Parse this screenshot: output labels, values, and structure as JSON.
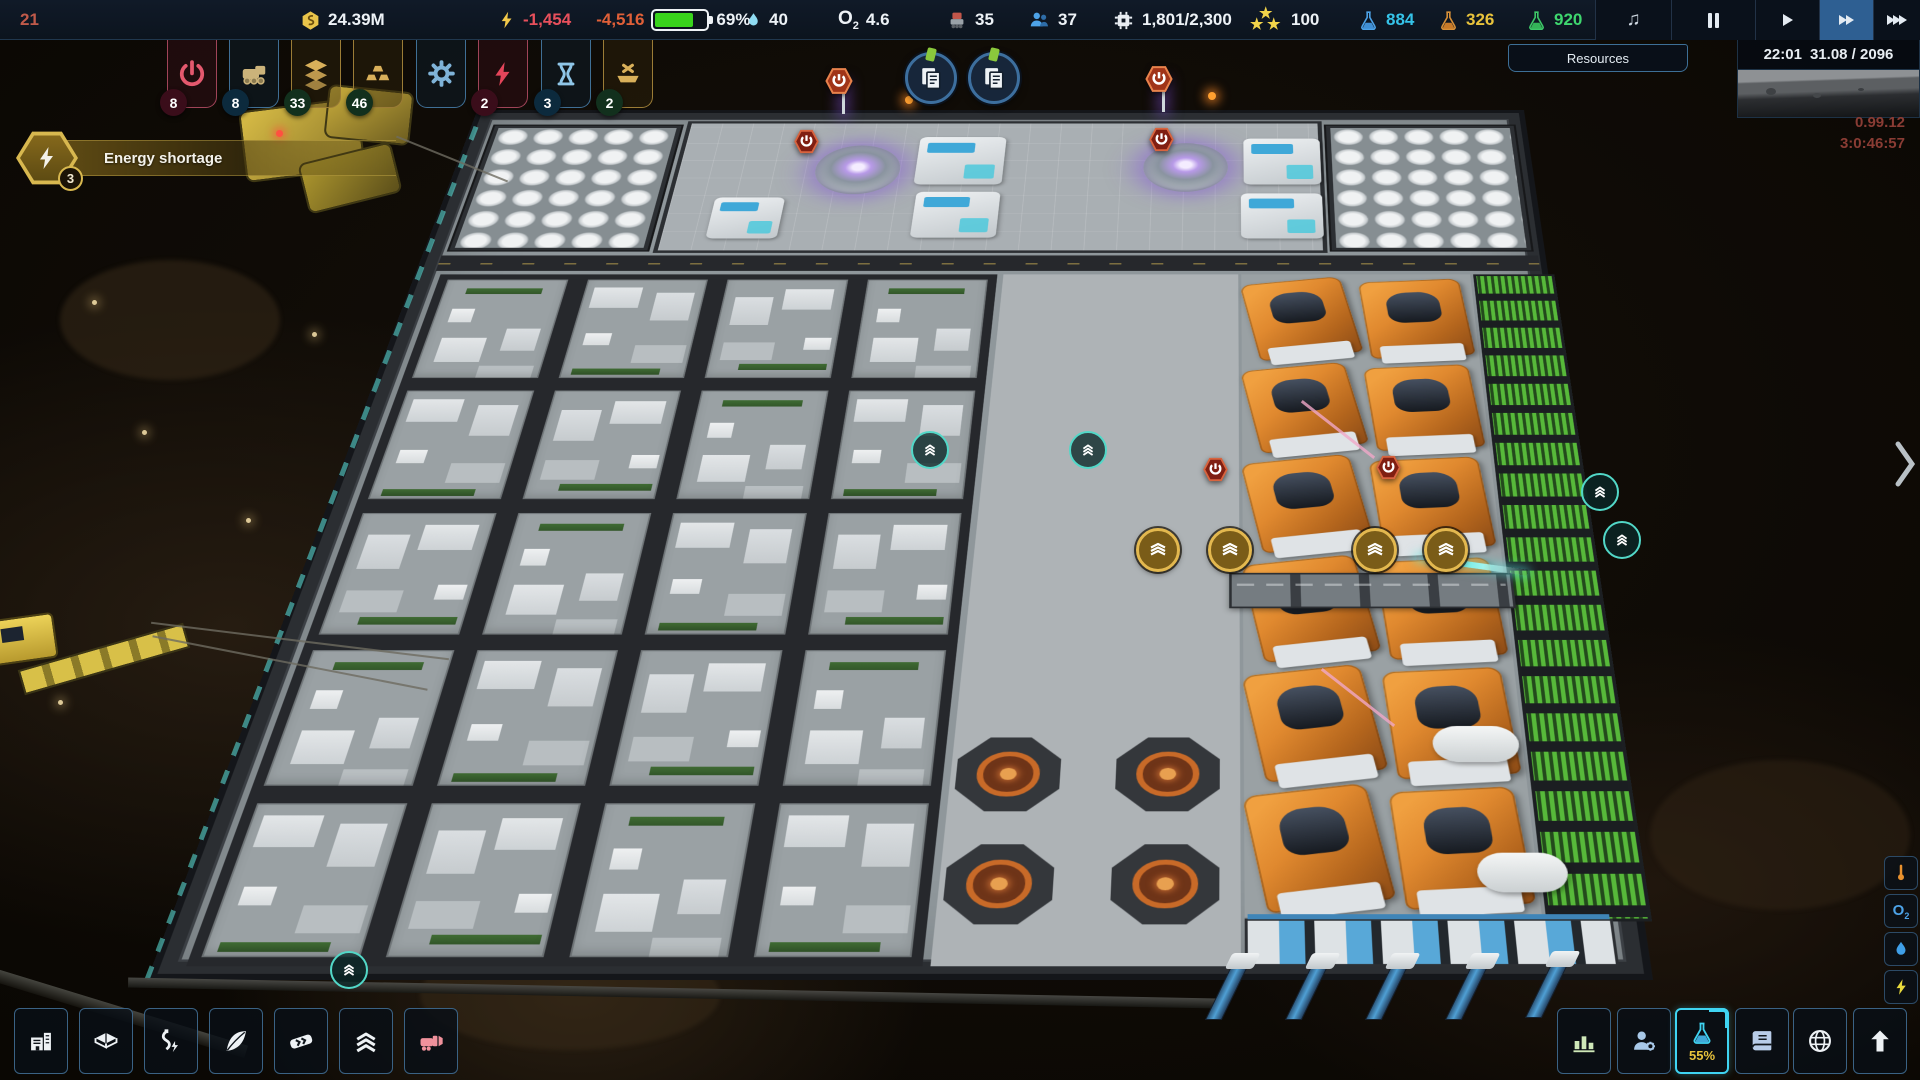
{
  "top_bar": {
    "fps": "21",
    "money": "24.39M",
    "energy_net": "-1,454",
    "energy_drain": "-4,516",
    "battery_percent": "69%",
    "battery_fill": 69,
    "water": "40",
    "oxygen": "4.6",
    "robots": "35",
    "population": "37",
    "compute": "1,801/2,300",
    "points": "100",
    "science_blue": "884",
    "science_orange": "326",
    "science_green": "920"
  },
  "labels": {
    "o": "O",
    "o_sub": "2"
  },
  "clock_panel": {
    "time": "22:01",
    "date": "31.08 / 2096",
    "version": "0.99.12",
    "session_time": "3:0:46:57"
  },
  "tooltip": {
    "label": "Resources"
  },
  "alert": {
    "label": "Energy shortage",
    "count": "3"
  },
  "build_menu": {
    "items": [
      {
        "icon": "power-icon",
        "badge": "8",
        "color": "red"
      },
      {
        "icon": "rover-icon",
        "badge": "8",
        "color": "blue"
      },
      {
        "icon": "layers-icon",
        "badge": "33",
        "color": "gold"
      },
      {
        "icon": "gold-bars-icon",
        "badge": "46",
        "color": "gold"
      },
      {
        "icon": "gear-icon",
        "badge": "",
        "color": "blue"
      },
      {
        "icon": "lightning-icon",
        "badge": "2",
        "color": "red"
      },
      {
        "icon": "hourglass-icon",
        "badge": "3",
        "color": "blue"
      },
      {
        "icon": "ship-bowl-icon",
        "badge": "2",
        "color": "gold"
      }
    ]
  },
  "bottom_left_menu": {
    "icons": [
      "buildings",
      "platforms",
      "cables",
      "terraform",
      "conveyors",
      "levels",
      "demolish"
    ]
  },
  "bottom_right_menu": {
    "icons": [
      "statistics",
      "citizens",
      "research",
      "encyclopedia",
      "planet",
      "upgrades"
    ],
    "research_progress": "55%"
  },
  "side_toggles": {
    "icons": [
      "temperature",
      "oxygen",
      "water",
      "energy"
    ]
  },
  "playback": {
    "icons": [
      "music",
      "pause",
      "play",
      "fast-forward",
      "fastest-forward"
    ],
    "active": "fast-forward"
  },
  "map": {
    "overlay_icons": [
      "documents",
      "power-off",
      "storage-full",
      "transport"
    ]
  },
  "colors": {
    "accent_blue": "#35c3e8",
    "money_yellow": "#e9c44a",
    "alert_red": "#e0455a",
    "battery_green": "#39d41c",
    "science_blue": "#35c3e8",
    "science_orange": "#e8a93c",
    "science_green": "#3ed66e",
    "gold": "#d8b84f",
    "machine_orange": "#e0892f",
    "farm_green": "#56bb3a",
    "platform_gray": "#99a0a4"
  }
}
